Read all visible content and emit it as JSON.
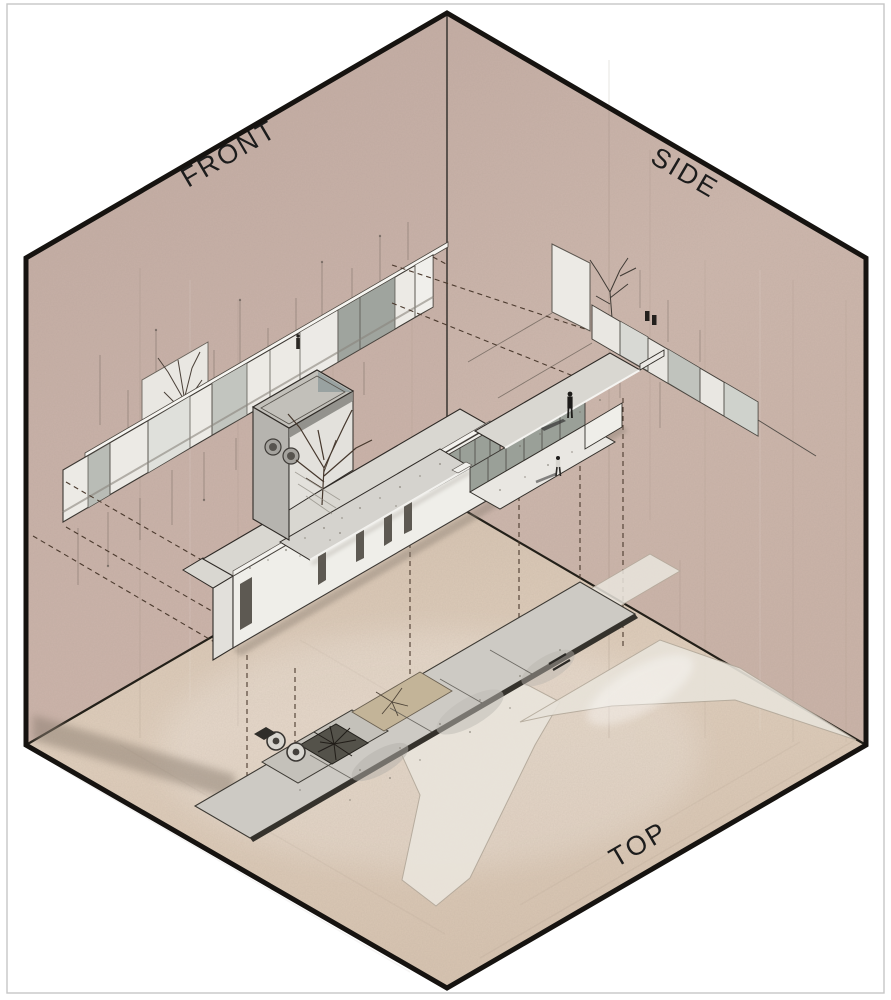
{
  "diagram": {
    "kind": "axonometric-projection-box",
    "labels": {
      "front": "FRONT",
      "side": "SIDE",
      "top": "TOP"
    }
  },
  "palette": {
    "front_wall": "#c7b0a7",
    "side_wall": "#ccb6ac",
    "floor": "#dccab8",
    "outline": "#161310",
    "page_border": "#c6c6c6",
    "label_ink": "#1c1c1c",
    "dashed_ink": "#4b3a2e",
    "concrete_roof": "#d9d7d1",
    "white_wall": "#efeee9",
    "glass": "#9aa098",
    "plan_dark": "#54524a",
    "plan_tan": "#c3b498",
    "path_pale": "#e9e4db",
    "shadow": "#8a7d70",
    "figure": "#1d1b19"
  }
}
